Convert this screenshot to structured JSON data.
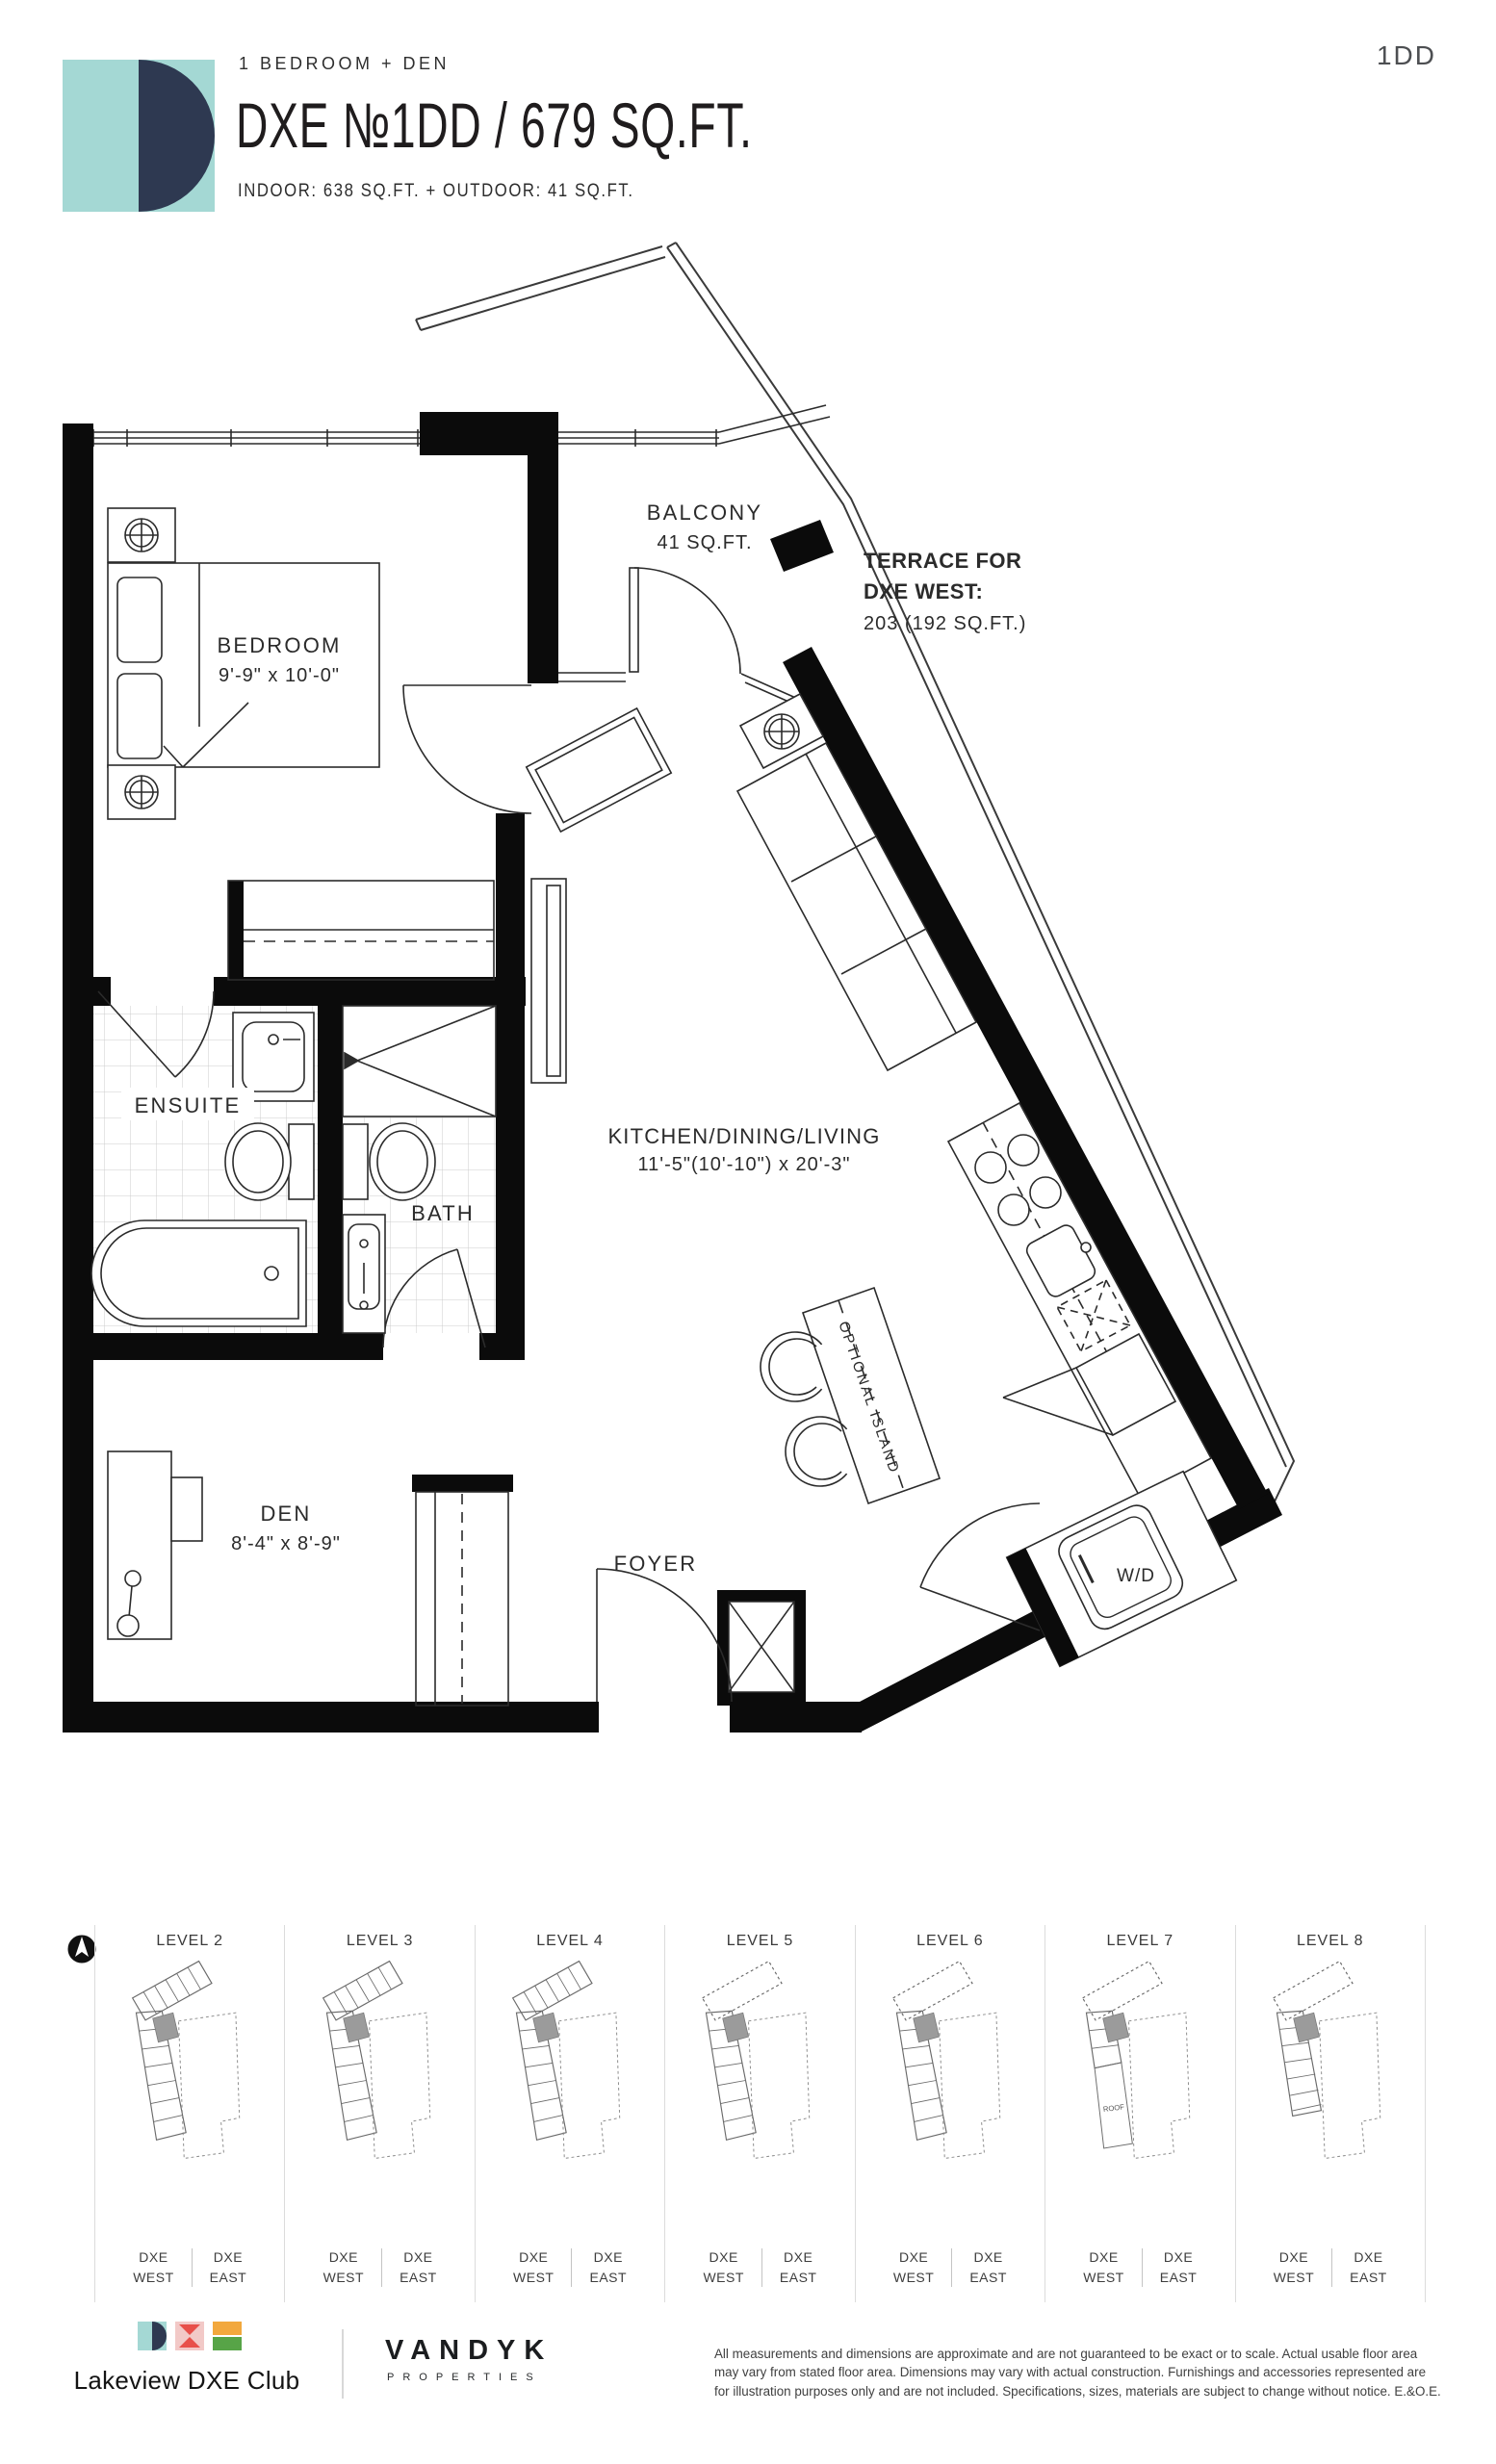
{
  "header": {
    "unit_type": "1 BEDROOM + DEN",
    "title": "DXE №1DD / 679 SQ.FT.",
    "subtitle": "INDOOR: 638 SQ.FT. + OUTDOOR: 41 SQ.FT.",
    "unit_code": "1DD"
  },
  "plan": {
    "balcony_name": "BALCONY",
    "balcony_area": "41 SQ.FT.",
    "terrace_line1": "TERRACE FOR",
    "terrace_line2": "DXE WEST:",
    "terrace_line3": "203 (192 SQ.FT.)",
    "bedroom_name": "BEDROOM",
    "bedroom_dims": "9'-9\" x 10'-0\"",
    "ensuite_name": "ENSUITE",
    "bath_name": "BATH",
    "kitchen_name": "KITCHEN/DINING/LIVING",
    "kitchen_dims": "11'-5\"(10'-10\") x 20'-3\"",
    "den_name": "DEN",
    "den_dims": "8'-4\" x 8'-9\"",
    "foyer_name": "FOYER",
    "wd_label": "W/D",
    "island_label": "OPTIONAL ISLAND"
  },
  "levels": {
    "roof_label": "ROOF",
    "items": [
      {
        "label": "LEVEL 2",
        "west": "DXE WEST",
        "east": "DXE EAST",
        "dashed_top": false,
        "variant": "tall"
      },
      {
        "label": "LEVEL 3",
        "west": "DXE WEST",
        "east": "DXE EAST",
        "dashed_top": false,
        "variant": "tall"
      },
      {
        "label": "LEVEL 4",
        "west": "DXE WEST",
        "east": "DXE EAST",
        "dashed_top": false,
        "variant": "tall"
      },
      {
        "label": "LEVEL 5",
        "west": "DXE WEST",
        "east": "DXE EAST",
        "dashed_top": true,
        "variant": "tall"
      },
      {
        "label": "LEVEL 6",
        "west": "DXE WEST",
        "east": "DXE EAST",
        "dashed_top": true,
        "variant": "tall"
      },
      {
        "label": "LEVEL 7",
        "west": "DXE WEST",
        "east": "DXE EAST",
        "dashed_top": true,
        "variant": "roof"
      },
      {
        "label": "LEVEL 8",
        "west": "DXE WEST",
        "east": "DXE EAST",
        "dashed_top": true,
        "variant": "short"
      }
    ]
  },
  "footer": {
    "brand": "Lakeview DXE Club",
    "developer": "VANDYK",
    "developer_sub": "PROPERTIES",
    "disclaimer": "All measurements and dimensions are approximate and are not guaranteed to be exact or to scale. Actual usable floor area may vary from stated floor area. Dimensions may vary with actual construction. Furnishings and accessories represented are for illustration purposes only and are not included. Specifications, sizes, materials are subject to change without notice. E.&O.E."
  },
  "colors": {
    "teal": "#a4d8d4",
    "navy": "#2e3951",
    "pink": "#f2c9c7",
    "red": "#e8504a",
    "amber": "#f2a83d",
    "green": "#57a447",
    "wall_black": "#0b0b0b",
    "unit_highlight": "#9b9b9b"
  }
}
